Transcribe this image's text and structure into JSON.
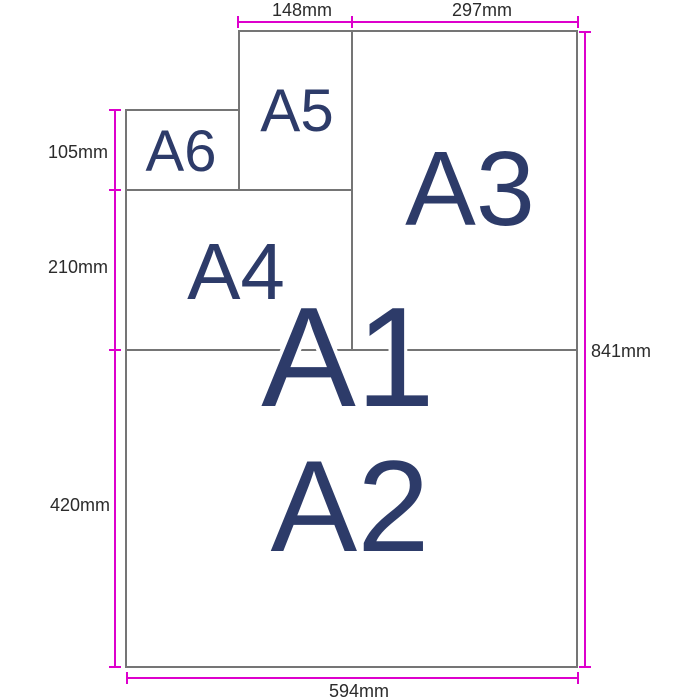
{
  "diagram": {
    "description": "A-series paper size subdivision diagram",
    "papers": {
      "a1": "A1",
      "a2": "A2",
      "a3": "A3",
      "a4": "A4",
      "a5": "A5",
      "a6": "A6"
    },
    "dimensions": {
      "top_148": "148mm",
      "top_297": "297mm",
      "right_841": "841mm",
      "left_105": "105mm",
      "left_210": "210mm",
      "left_420": "420mm",
      "bottom_594": "594mm"
    },
    "colors": {
      "dimension_line": "#dd00cc",
      "paper_border": "#757575",
      "paper_label": "#2d3b69",
      "dimension_text": "#2b2b2b",
      "background": "#ffffff"
    }
  }
}
